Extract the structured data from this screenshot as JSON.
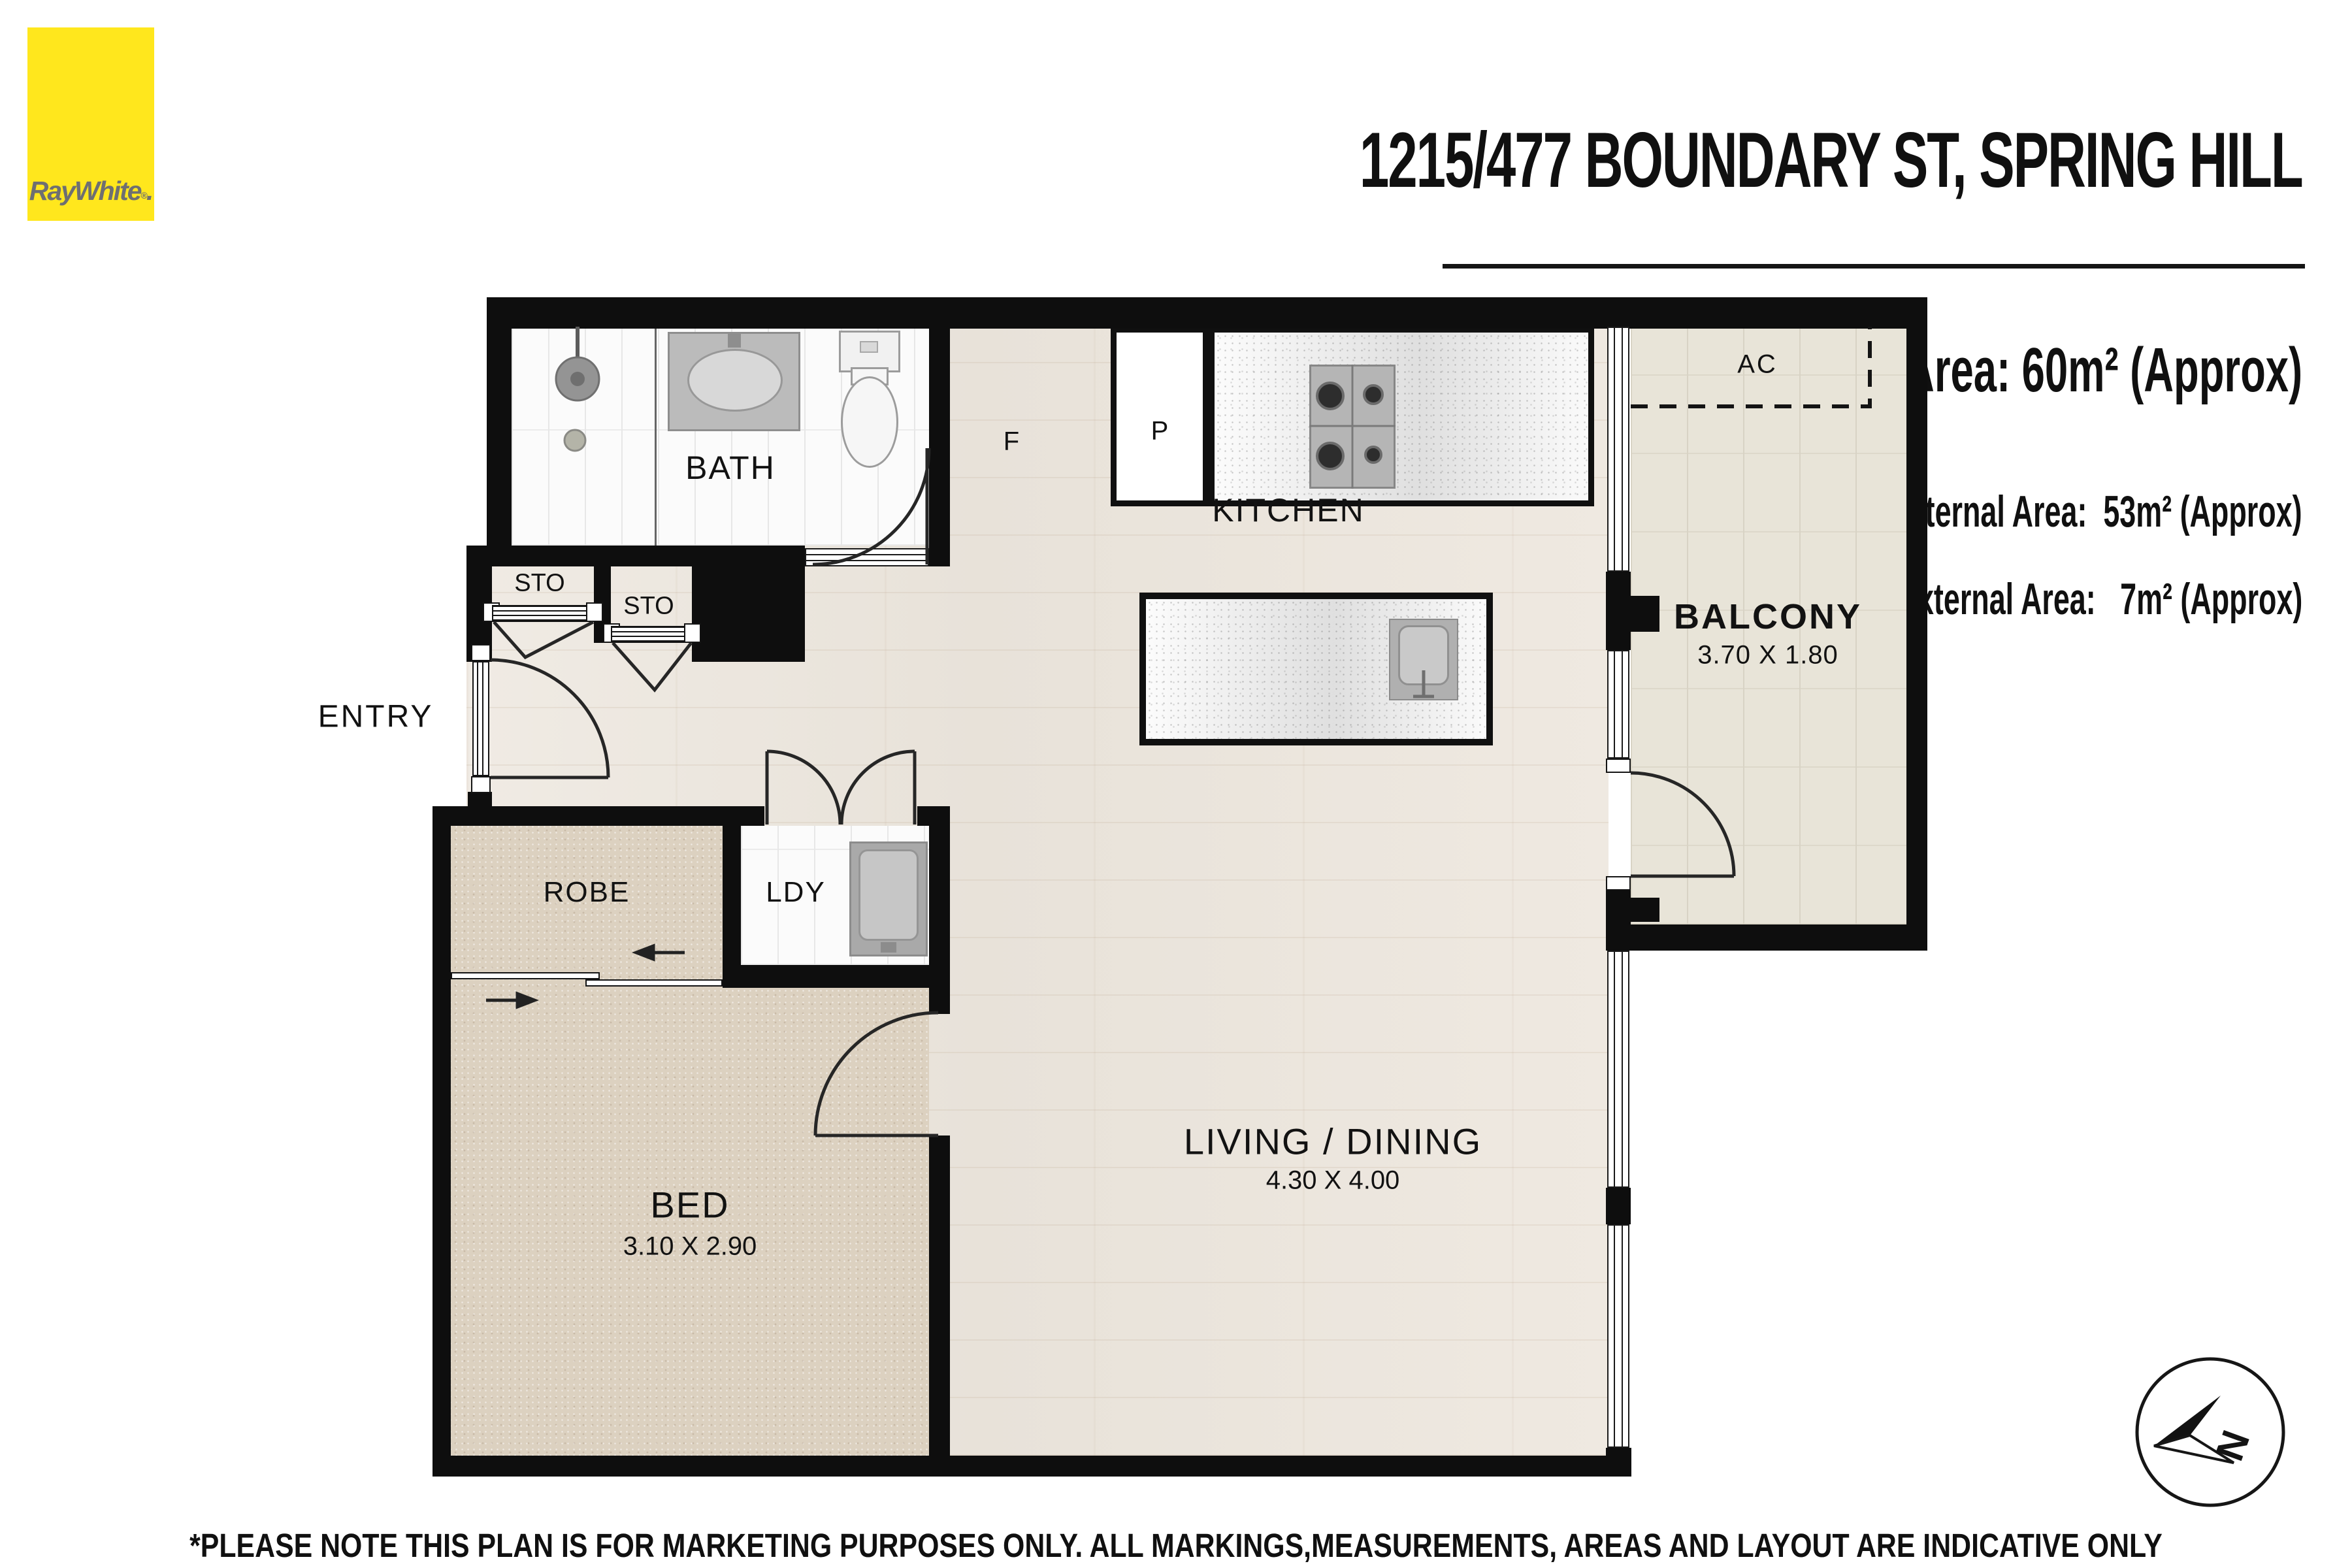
{
  "brand": {
    "logo_text": "RayWhite",
    "logo_suffix": ".",
    "logo_reg": "®"
  },
  "header": {
    "title": "1215/477 BOUNDARY ST, SPRING HILL",
    "total_area": "Total Area: 60m² (Approx)",
    "internal_area": "Internal Area:  53m² (Approx)",
    "external_area": "External Area:   7m² (Approx)"
  },
  "rooms": {
    "bath": "BATH",
    "kitchen": "KITCHEN",
    "balcony": "BALCONY",
    "balcony_dims": "3.70 X 1.80",
    "entry": "ENTRY",
    "sto_left": "STO",
    "sto_right": "STO",
    "robe": "ROBE",
    "ldy": "LDY",
    "bed": "BED",
    "bed_dims": "3.10 X 2.90",
    "living": "LIVING / DINING",
    "living_dims": "4.30 X 4.00",
    "fridge": "F",
    "pantry": "P",
    "ac": "AC"
  },
  "compass": {
    "north": "N"
  },
  "footer": {
    "disclaimer": "*PLEASE NOTE THIS PLAN IS FOR MARKETING PURPOSES ONLY. ALL MARKINGS,MEASUREMENTS, AREAS AND LAYOUT ARE INDICATIVE ONLY AND NOT TO BE RELIED UPON."
  }
}
